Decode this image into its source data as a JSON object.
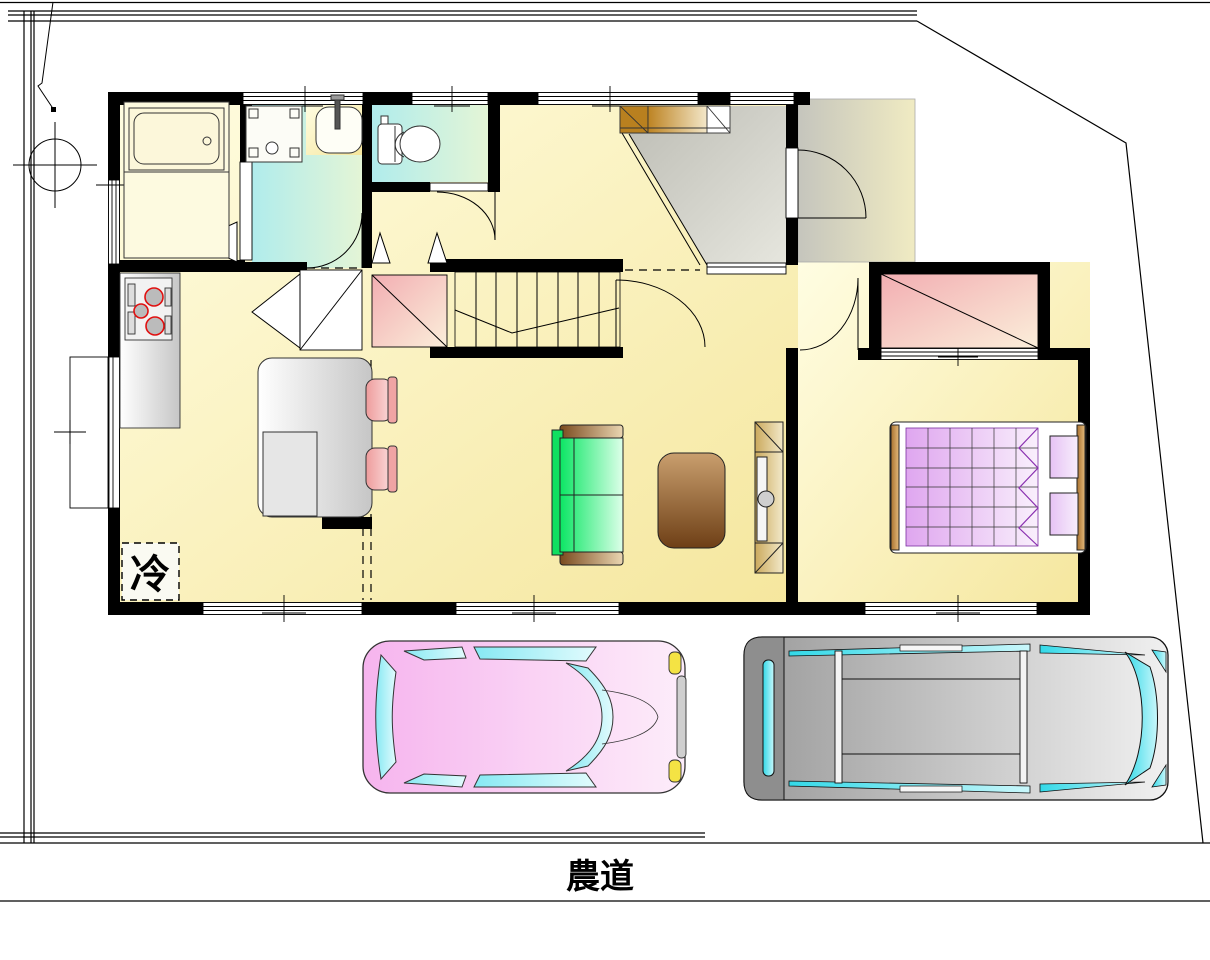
{
  "labels": {
    "refrigerator": "冷",
    "road": "農道"
  },
  "colors": {
    "paper": "#FFFFFF",
    "ink": "#000000",
    "wall": "#000000",
    "boundary-line": "#000000",
    "floor-yellow": "#FBF2B4",
    "wet-floor-cyan": "#BCEDE8",
    "genkan-gray": "#CBCBC3",
    "closet-pink": "#F4B6B6",
    "sofa-green": "#10E060",
    "coffee-table-brown": "#8A5A28",
    "tv-board-tan": "#DFC487",
    "bed-quilt-purple": "#E2AAF0",
    "chair-pink": "#F2AAAA",
    "car-pink": "#F7C4F0",
    "car-window-cyan": "#8FEAF4",
    "van-gray": "#ABABAB",
    "van-window-cyan": "#3FDCEA",
    "headlight-yellow": "#F4E344",
    "stove-ring-red": "#E01010",
    "wood-brown": "#C08A4A"
  }
}
